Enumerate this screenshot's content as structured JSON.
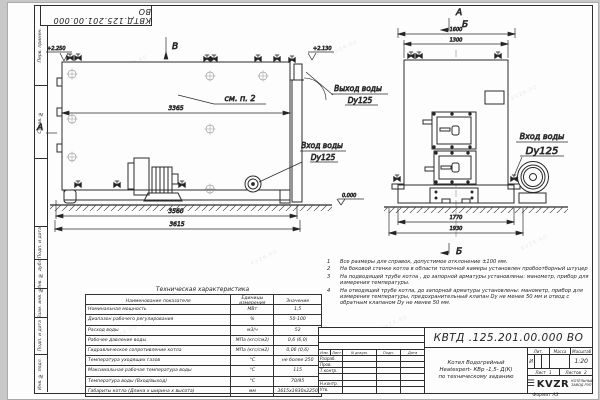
{
  "watermark": {
    "text": "KVZR.RU"
  },
  "stamp_top": {
    "designation": "КВТД.125.201.00.000  ВО"
  },
  "frame": {
    "left_labels": [
      "Перв. примен.",
      "Справ. №",
      "",
      "Подп. и дата",
      "Инв. № дубл.",
      "Взам. инв. №",
      "Подп. и дата",
      "Инв. № подл."
    ],
    "format_label": "Формат  А3"
  },
  "side_view": {
    "view_label": "В",
    "section_label": "А",
    "elevation_top": "+2.250",
    "elevation_chimney": "+2.130",
    "elevation_ground": "0.000",
    "see_note": "см. п. 2",
    "dim_length_body": "3365",
    "dim_length_base": "3560",
    "dim_length_overall": "3615",
    "inlet_line1": "Вход воды",
    "inlet_line2": "Dy125"
  },
  "front_view": {
    "section_label_a": "А",
    "section_label_b": "Б",
    "section_label_b_bottom": "Б",
    "dim_width_overall_top": "1600",
    "dim_width_body": "1300",
    "dim_width_base": "1770",
    "dim_width_overall": "1930",
    "outlet_line1": "Выход воды",
    "outlet_line2": "Dy125",
    "inlet_line1": "Вход воды",
    "inlet_line2": "Dy125"
  },
  "notes": {
    "items": [
      {
        "num": "1",
        "text": "Все размеры для справок, допустимое отклонение ±100 мм."
      },
      {
        "num": "2",
        "text": "На боковой стенке котла в области топочной камеры установлен пробоотборный штуцер"
      },
      {
        "num": "3",
        "text": "На  подводящей трубе котла , до запорной арматуры установлены: манометр, прибор для измерения температуры."
      },
      {
        "num": "4",
        "text": "На отводящей трубе котла, до запорной арматуры установлены: манометр, прибор для измерения температуры, предохранительный клапан Dу не менее 50 мм и отвод с обратным клапаном Dу не менее 50 мм."
      }
    ]
  },
  "tech_table": {
    "title": "Техническая характеристика",
    "headers": [
      "Наименование показателя",
      "Единицы измерения",
      "Значение"
    ],
    "rows": [
      [
        "Номинальная мощность",
        "МВт",
        "1,5"
      ],
      [
        "Диапазон рабочего регулирования",
        "%",
        "50-100"
      ],
      [
        "Расход воды",
        "м3/ч",
        "52"
      ],
      [
        "Рабочее давление воды",
        "МПа (кгс/см2)",
        "0,6 (6,0)"
      ],
      [
        "Гидравлическое сопротивление котла",
        "МПа (кгс/см2)",
        "0,06 (0,6)"
      ],
      [
        "Температура уходящих газов",
        "°С",
        "не более 250"
      ],
      [
        "Максимальная рабочая температура воды",
        "°С",
        "115"
      ],
      [
        "Температура воды (Вход/выход)",
        "°С",
        "70/95"
      ],
      [
        "Габариты котла (Длина х ширина х высота)",
        "мм",
        "3615х1930х2250"
      ]
    ]
  },
  "title_block": {
    "designation": "КВТД .125.201.00.000  ВО",
    "doc_name_1": "Котел Водогрейный",
    "doc_name_2": "Heatexpert- КВр -1,5- Д(К)",
    "doc_name_3": "по техническому заданию",
    "header_cols": [
      "Изм.",
      "Лист",
      "N докум.",
      "Подп.",
      "Дата"
    ],
    "row_labels": [
      "Разраб.",
      "Пров.",
      "Т.контр.",
      "",
      "Н.контр.",
      "Утв."
    ],
    "lit_header": "Лит.",
    "mass_header": "Масса",
    "scale_header": "Масштаб",
    "lit_value": "И",
    "scale_value": "1:20",
    "sheet_label": "Лист",
    "sheet_value": "1",
    "sheets_label": "Листов",
    "sheets_value": "2",
    "logo_icon": "☰",
    "company_logo": "KVZR",
    "company_name_1": "КОТЕЛЬНЫЙ",
    "company_name_2": "ЗАВОД РЭП"
  }
}
